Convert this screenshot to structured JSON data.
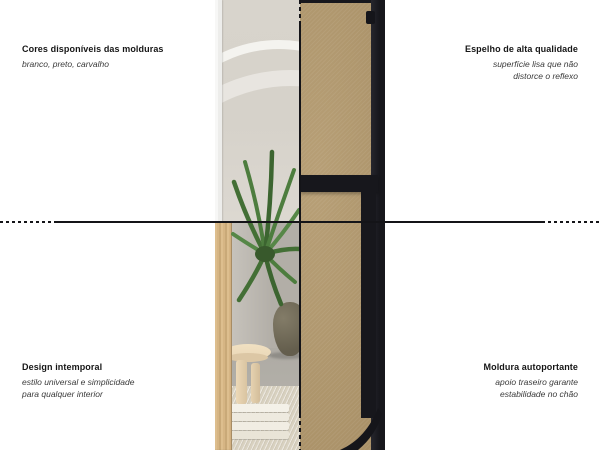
{
  "annotations": {
    "top_left": {
      "title": "Cores disponíveis das molduras",
      "lines": [
        "branco, preto, carvalho"
      ]
    },
    "top_right": {
      "title": "Espelho de alta qualidade",
      "lines": [
        "superfície lisa que não",
        "distorce o reflexo"
      ]
    },
    "bottom_left": {
      "title": "Design intemporal",
      "lines": [
        "estilo universal e simplicidade",
        "para qualquer interior"
      ]
    },
    "bottom_right": {
      "title": "Moldura autoportante",
      "lines": [
        "apoio traseiro garante",
        "estabilidade no chão"
      ]
    }
  },
  "colors": {
    "background": "#ffffff",
    "divider_line": "#141418",
    "heading_text": "#161616",
    "subtitle_text": "#3a3a3a",
    "mdf_board": "#b2986c",
    "frame_black": "#17171c",
    "frame_oak": "#d6b584",
    "frame_white": "#ededeb",
    "mirror_reflection": "#d6d2ca",
    "plant_green": "#4a7a3c",
    "stool_wood": "#e9d6b6",
    "rug_beige": "#d8d1c0"
  }
}
